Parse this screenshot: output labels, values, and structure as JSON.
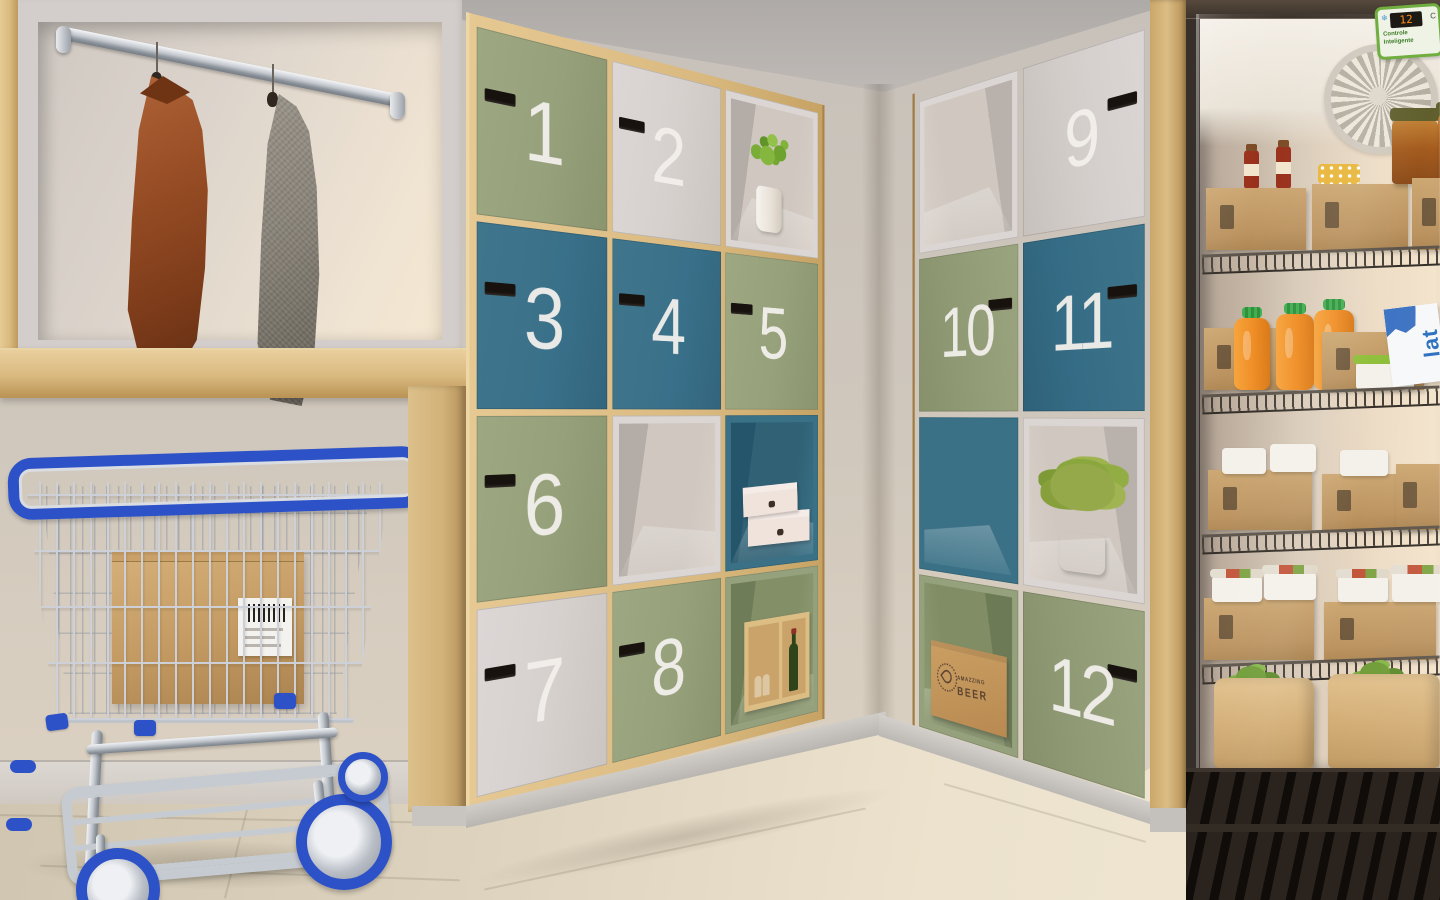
{
  "lockers": {
    "left_wall": {
      "cells": [
        {
          "type": "door",
          "color": "sage",
          "label": "1"
        },
        {
          "type": "door",
          "color": "gray",
          "label": "2"
        },
        {
          "type": "open",
          "color": "white",
          "label": null,
          "contents": "potted-plant-white-pot"
        },
        {
          "type": "door",
          "color": "teal",
          "label": "3"
        },
        {
          "type": "door",
          "color": "teal",
          "label": "4"
        },
        {
          "type": "door",
          "color": "sage",
          "label": "5"
        },
        {
          "type": "door",
          "color": "sage",
          "label": "6"
        },
        {
          "type": "open",
          "color": "white",
          "label": null,
          "contents": "empty"
        },
        {
          "type": "open",
          "color": "teal",
          "label": null,
          "contents": "two-white-shoe-boxes"
        },
        {
          "type": "door",
          "color": "gray",
          "label": "7"
        },
        {
          "type": "door",
          "color": "sage",
          "label": "8"
        },
        {
          "type": "open",
          "color": "sage",
          "label": null,
          "contents": "wood-crate-wine-bottle-glasses"
        }
      ]
    },
    "right_wall": {
      "cells": [
        {
          "type": "open",
          "color": "white",
          "label": null,
          "contents": "empty"
        },
        {
          "type": "door",
          "color": "gray",
          "label": "9"
        },
        {
          "type": "door",
          "color": "sage",
          "label": "10"
        },
        {
          "type": "door",
          "color": "teal",
          "label": "11"
        },
        {
          "type": "open",
          "color": "teal",
          "label": null,
          "contents": "empty"
        },
        {
          "type": "open",
          "color": "white",
          "label": null,
          "contents": "potted-bush-striped-pot"
        },
        {
          "type": "open",
          "color": "sage",
          "label": null,
          "contents": "beer-cardboard-box"
        },
        {
          "type": "door",
          "color": "sage",
          "label": "12"
        }
      ]
    }
  },
  "beer_box": {
    "line1": "AMAZZING",
    "line2": "BEER"
  },
  "closet": {
    "items": [
      "leather-jacket-brown",
      "wool-coat-gray"
    ],
    "fixture": "chrome-hanging-rail"
  },
  "cart": {
    "type": "chrome-wire-laundry-cart",
    "accent": "blue",
    "contents": "cardboard-box-with-shipping-label"
  },
  "fridge": {
    "display": {
      "value": "12",
      "unit": "C",
      "label_line1": "Controle",
      "label_line2": "Inteligente"
    },
    "milk_label": "lat",
    "shelf_items": [
      [
        "kraft-crates",
        "sauce-bottles",
        "polka-dot-lid-jar",
        "preserve-jars"
      ],
      [
        "orange-juice-bottles",
        "kraft-crates",
        "milk-carton",
        "green-lid-tub"
      ],
      [
        "kraft-crates",
        "white-lid-tubs",
        "salad-pack"
      ],
      [
        "kraft-crates",
        "printed-lid-food-tubs"
      ]
    ],
    "floor_items": [
      "kraft-paper-bags-with-greens",
      "eggplant"
    ]
  },
  "palette": {
    "wood": "#d9b97f",
    "sage_door": "#96a17b",
    "teal_door": "#3a718a",
    "white_door": "#d6d0cd",
    "cart_blue": "#2d52c8",
    "kraft": "#c49a65",
    "fridge_frame": "#37302a",
    "wall": "#cdc6be",
    "floor": "#ded5c2",
    "number_text": "#f3f0ec"
  }
}
